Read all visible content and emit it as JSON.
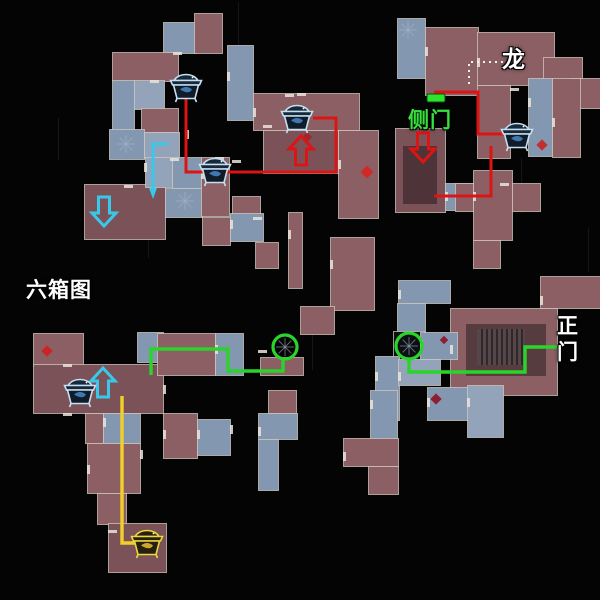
{
  "labels": [
    {
      "id": "dragon",
      "text": "龙",
      "x": 502,
      "y": 40,
      "size": 23,
      "color": "#ffffff",
      "vertical": false
    },
    {
      "id": "side-door",
      "text": "侧门",
      "x": 408,
      "y": 104,
      "size": 21,
      "color": "#35e23c",
      "vertical": false
    },
    {
      "id": "six-box-map",
      "text": "六箱图",
      "x": 26,
      "y": 274,
      "size": 21,
      "color": "#ffffff",
      "vertical": false
    },
    {
      "id": "main-gate",
      "text": "正门",
      "x": 557,
      "y": 314,
      "size": 21,
      "color": "#ffffff",
      "vertical": true
    }
  ],
  "map": {
    "width": 600,
    "height": 600,
    "palette": {
      "bg": "#040404",
      "r": "#8b5f63",
      "R": "#7b5257",
      "b": "#8497b0",
      "B": "#92a3ba",
      "k": "#0c0f13",
      "border": "#cfc8bd",
      "inner_shadow": "rgba(16,12,14,0.42)",
      "stairs_base": "#564649",
      "stairs_line": "#2e282b",
      "route_red": "#dd1414",
      "route_green": "#2bd42b",
      "route_yellow": "#f2cf2a",
      "route_cyan": "#3ac8ea",
      "door_green": "#2de52d",
      "dotted": "#f2f2f2",
      "chest_stroke": "#c6dff0",
      "chest_fill": "#101c2a",
      "chest_lid": "#16293a",
      "chest_ornament": "#3f78b0",
      "chest_gold": "#ecd73e",
      "chest_gold_fill": "#262010",
      "chest_gold_ornament": "#caa92c",
      "spiral": "#a9b6c6",
      "scratch": "#161616",
      "door_dash": "#eae4da"
    },
    "rooms": [
      [
        163,
        22,
        33,
        31,
        "b"
      ],
      [
        194,
        13,
        28,
        40,
        "r"
      ],
      [
        112,
        52,
        66,
        29,
        "r"
      ],
      [
        227,
        45,
        26,
        75,
        "b"
      ],
      [
        253,
        93,
        106,
        37,
        "r"
      ],
      [
        263,
        130,
        75,
        43,
        "R"
      ],
      [
        338,
        130,
        40,
        88,
        "r"
      ],
      [
        112,
        80,
        22,
        78,
        "b"
      ],
      [
        134,
        80,
        30,
        29,
        "B"
      ],
      [
        141,
        108,
        37,
        24,
        "r"
      ],
      [
        109,
        129,
        35,
        30,
        "b"
      ],
      [
        144,
        132,
        35,
        26,
        "B"
      ],
      [
        84,
        184,
        81,
        55,
        "R"
      ],
      [
        145,
        157,
        27,
        30,
        "B"
      ],
      [
        172,
        157,
        29,
        31,
        "b"
      ],
      [
        165,
        188,
        37,
        29,
        "b"
      ],
      [
        201,
        157,
        28,
        59,
        "r"
      ],
      [
        232,
        196,
        28,
        29,
        "r"
      ],
      [
        202,
        217,
        28,
        28,
        "r"
      ],
      [
        230,
        213,
        33,
        28,
        "b"
      ],
      [
        255,
        242,
        23,
        26,
        "r"
      ],
      [
        288,
        212,
        14,
        76,
        "r"
      ],
      [
        397,
        18,
        28,
        60,
        "b"
      ],
      [
        425,
        27,
        53,
        68,
        "r"
      ],
      [
        477,
        32,
        77,
        53,
        "r"
      ],
      [
        543,
        57,
        39,
        33,
        "r"
      ],
      [
        570,
        78,
        30,
        30,
        "r"
      ],
      [
        528,
        78,
        24,
        78,
        "b"
      ],
      [
        552,
        78,
        28,
        79,
        "r"
      ],
      [
        477,
        85,
        33,
        73,
        "r"
      ],
      [
        395,
        128,
        50,
        84,
        "R"
      ],
      [
        445,
        183,
        32,
        27,
        "b"
      ],
      [
        473,
        170,
        39,
        70,
        "r"
      ],
      [
        455,
        183,
        18,
        28,
        "r"
      ],
      [
        512,
        183,
        28,
        28,
        "r"
      ],
      [
        473,
        240,
        27,
        28,
        "r"
      ],
      [
        398,
        280,
        52,
        23,
        "b"
      ],
      [
        397,
        303,
        28,
        33,
        "b"
      ],
      [
        330,
        237,
        44,
        73,
        "r"
      ],
      [
        300,
        306,
        34,
        28,
        "r"
      ],
      [
        393,
        331,
        31,
        29,
        "k"
      ],
      [
        450,
        308,
        107,
        87,
        "r"
      ],
      [
        540,
        276,
        60,
        32,
        "r"
      ],
      [
        420,
        332,
        37,
        27,
        "b"
      ],
      [
        375,
        356,
        24,
        64,
        "b"
      ],
      [
        398,
        359,
        42,
        26,
        "B"
      ],
      [
        427,
        387,
        56,
        33,
        "b"
      ],
      [
        467,
        385,
        36,
        52,
        "B"
      ],
      [
        370,
        390,
        27,
        50,
        "b"
      ],
      [
        343,
        438,
        55,
        28,
        "r"
      ],
      [
        368,
        466,
        30,
        28,
        "r"
      ],
      [
        268,
        390,
        28,
        23,
        "r"
      ],
      [
        258,
        413,
        39,
        26,
        "b"
      ],
      [
        258,
        439,
        20,
        51,
        "b"
      ],
      [
        33,
        333,
        50,
        33,
        "r"
      ],
      [
        33,
        364,
        130,
        49,
        "R"
      ],
      [
        137,
        332,
        26,
        30,
        "b"
      ],
      [
        157,
        333,
        58,
        42,
        "r"
      ],
      [
        215,
        333,
        28,
        42,
        "b"
      ],
      [
        260,
        357,
        43,
        18,
        "r"
      ],
      [
        85,
        413,
        18,
        30,
        "r"
      ],
      [
        103,
        413,
        37,
        30,
        "b"
      ],
      [
        87,
        443,
        53,
        50,
        "r"
      ],
      [
        97,
        493,
        29,
        31,
        "r"
      ],
      [
        108,
        523,
        58,
        49,
        "R"
      ],
      [
        163,
        413,
        34,
        45,
        "r"
      ],
      [
        197,
        419,
        33,
        36,
        "b"
      ]
    ],
    "inner_shades": [
      [
        466,
        324,
        80,
        52
      ],
      [
        403,
        146,
        34,
        58
      ]
    ],
    "stairs": {
      "x": 477,
      "y": 329,
      "w": 48,
      "h": 36,
      "step": 5
    },
    "spirals": [
      [
        126,
        144
      ],
      [
        185,
        201
      ],
      [
        408,
        30
      ],
      [
        285,
        347
      ],
      [
        409,
        346
      ]
    ],
    "scratches": [
      [
        238,
        2,
        1,
        46
      ],
      [
        521,
        158,
        1,
        55
      ],
      [
        58,
        118,
        1,
        42
      ],
      [
        312,
        332,
        1,
        38
      ],
      [
        148,
        228,
        1,
        30
      ],
      [
        588,
        228,
        1,
        44
      ]
    ],
    "door_dashes": [
      [
        173,
        52,
        9,
        3
      ],
      [
        150,
        80,
        9,
        3
      ],
      [
        227,
        72,
        3,
        9
      ],
      [
        253,
        108,
        3,
        9
      ],
      [
        285,
        94,
        9,
        3
      ],
      [
        170,
        158,
        9,
        3
      ],
      [
        201,
        170,
        3,
        9
      ],
      [
        124,
        185,
        9,
        3
      ],
      [
        144,
        163,
        3,
        9
      ],
      [
        232,
        160,
        9,
        3
      ],
      [
        263,
        125,
        9,
        3
      ],
      [
        338,
        160,
        3,
        9
      ],
      [
        425,
        47,
        3,
        9
      ],
      [
        477,
        58,
        3,
        9
      ],
      [
        510,
        88,
        9,
        3
      ],
      [
        528,
        98,
        3,
        9
      ],
      [
        552,
        118,
        3,
        9
      ],
      [
        445,
        192,
        3,
        9
      ],
      [
        473,
        192,
        3,
        9
      ],
      [
        500,
        183,
        9,
        3
      ],
      [
        420,
        340,
        3,
        9
      ],
      [
        450,
        345,
        3,
        9
      ],
      [
        467,
        398,
        3,
        9
      ],
      [
        427,
        398,
        3,
        9
      ],
      [
        375,
        372,
        3,
        9
      ],
      [
        398,
        372,
        3,
        9
      ],
      [
        540,
        296,
        3,
        9
      ],
      [
        163,
        385,
        3,
        9
      ],
      [
        103,
        418,
        3,
        9
      ],
      [
        140,
        450,
        3,
        9
      ],
      [
        163,
        430,
        3,
        9
      ],
      [
        197,
        430,
        3,
        9
      ],
      [
        230,
        425,
        3,
        9
      ],
      [
        258,
        427,
        3,
        9
      ],
      [
        87,
        465,
        3,
        9
      ],
      [
        108,
        530,
        9,
        3
      ],
      [
        215,
        345,
        3,
        9
      ],
      [
        258,
        350,
        9,
        3
      ],
      [
        63,
        364,
        9,
        3
      ],
      [
        63,
        413,
        9,
        3
      ],
      [
        186,
        130,
        3,
        9
      ],
      [
        215,
        157,
        9,
        3
      ],
      [
        297,
        93,
        9,
        3
      ],
      [
        253,
        217,
        9,
        3
      ],
      [
        230,
        220,
        3,
        9
      ],
      [
        288,
        230,
        3,
        9
      ],
      [
        330,
        260,
        3,
        9
      ],
      [
        370,
        400,
        3,
        9
      ],
      [
        343,
        452,
        3,
        9
      ],
      [
        398,
        290,
        3,
        9
      ]
    ],
    "dotted_path": [
      [
        503,
        62
      ],
      [
        469,
        62
      ],
      [
        469,
        84
      ]
    ],
    "door_marker": {
      "x": 427,
      "y": 94,
      "w": 18,
      "h": 8
    },
    "routes": [
      {
        "name": "route-red-topleft",
        "color": "route_red",
        "width": 3,
        "points": [
          [
            186,
            97
          ],
          [
            186,
            172
          ],
          [
            336,
            172
          ],
          [
            336,
            118
          ],
          [
            313,
            118
          ]
        ]
      },
      {
        "name": "route-red-sidedoor-upper",
        "color": "route_red",
        "width": 3,
        "points": [
          [
            434,
            92
          ],
          [
            478,
            92
          ],
          [
            478,
            134
          ],
          [
            504,
            134
          ]
        ]
      },
      {
        "name": "route-red-sidedoor-lower",
        "color": "route_red",
        "width": 3,
        "points": [
          [
            491,
            146
          ],
          [
            491,
            196
          ],
          [
            434,
            196
          ]
        ]
      },
      {
        "name": "route-green-left",
        "color": "route_green",
        "width": 3.4,
        "points": [
          [
            151,
            375
          ],
          [
            151,
            349
          ],
          [
            228,
            349
          ],
          [
            228,
            371
          ],
          [
            283,
            371
          ],
          [
            283,
            360
          ]
        ]
      },
      {
        "name": "route-green-right",
        "color": "route_green",
        "width": 3.4,
        "points": [
          [
            409,
            359
          ],
          [
            409,
            372
          ],
          [
            525,
            372
          ],
          [
            525,
            347
          ],
          [
            558,
            347
          ]
        ]
      },
      {
        "name": "route-yellow",
        "color": "route_yellow",
        "width": 3.4,
        "points": [
          [
            122,
            396
          ],
          [
            122,
            543
          ],
          [
            135,
            543
          ]
        ]
      },
      {
        "name": "route-cyan",
        "color": "route_cyan",
        "width": 3,
        "points": [
          [
            168,
            144
          ],
          [
            153,
            144
          ],
          [
            153,
            190
          ]
        ]
      }
    ],
    "cyan_tip": [
      [
        149,
        188
      ],
      [
        157,
        188
      ],
      [
        153,
        199
      ]
    ],
    "circles": [
      {
        "x": 285,
        "y": 347,
        "r": 12
      },
      {
        "x": 409,
        "y": 346,
        "r": 13
      }
    ],
    "diamonds": [
      {
        "x": 367,
        "y": 172,
        "s": 9,
        "c": "#d32828"
      },
      {
        "x": 307,
        "y": 137,
        "s": 7,
        "c": "#a3242e"
      },
      {
        "x": 542,
        "y": 145,
        "s": 8,
        "c": "#c03030"
      },
      {
        "x": 47,
        "y": 351,
        "s": 8,
        "c": "#cc2424"
      },
      {
        "x": 436,
        "y": 399,
        "s": 8,
        "c": "#8c2030"
      },
      {
        "x": 444,
        "y": 340,
        "s": 6,
        "c": "#8c2030"
      }
    ],
    "arrows": [
      {
        "name": "cyan-down-arrow",
        "x": 104,
        "y": 211,
        "dir": "down",
        "color": "route_cyan"
      },
      {
        "name": "cyan-up-arrow",
        "x": 103,
        "y": 383,
        "dir": "up",
        "color": "route_cyan"
      },
      {
        "name": "red-up-arrow",
        "x": 301,
        "y": 151,
        "dir": "up",
        "color": "route_red"
      },
      {
        "name": "red-down-arrow",
        "x": 423,
        "y": 147,
        "dir": "down",
        "color": "route_red"
      }
    ],
    "chests": [
      {
        "x": 186,
        "y": 86,
        "variant": "blue"
      },
      {
        "x": 215,
        "y": 170,
        "variant": "blue"
      },
      {
        "x": 297,
        "y": 117,
        "variant": "blue"
      },
      {
        "x": 517,
        "y": 135,
        "variant": "blue"
      },
      {
        "x": 80,
        "y": 391,
        "variant": "blue"
      },
      {
        "x": 147,
        "y": 542,
        "variant": "gold"
      }
    ]
  }
}
